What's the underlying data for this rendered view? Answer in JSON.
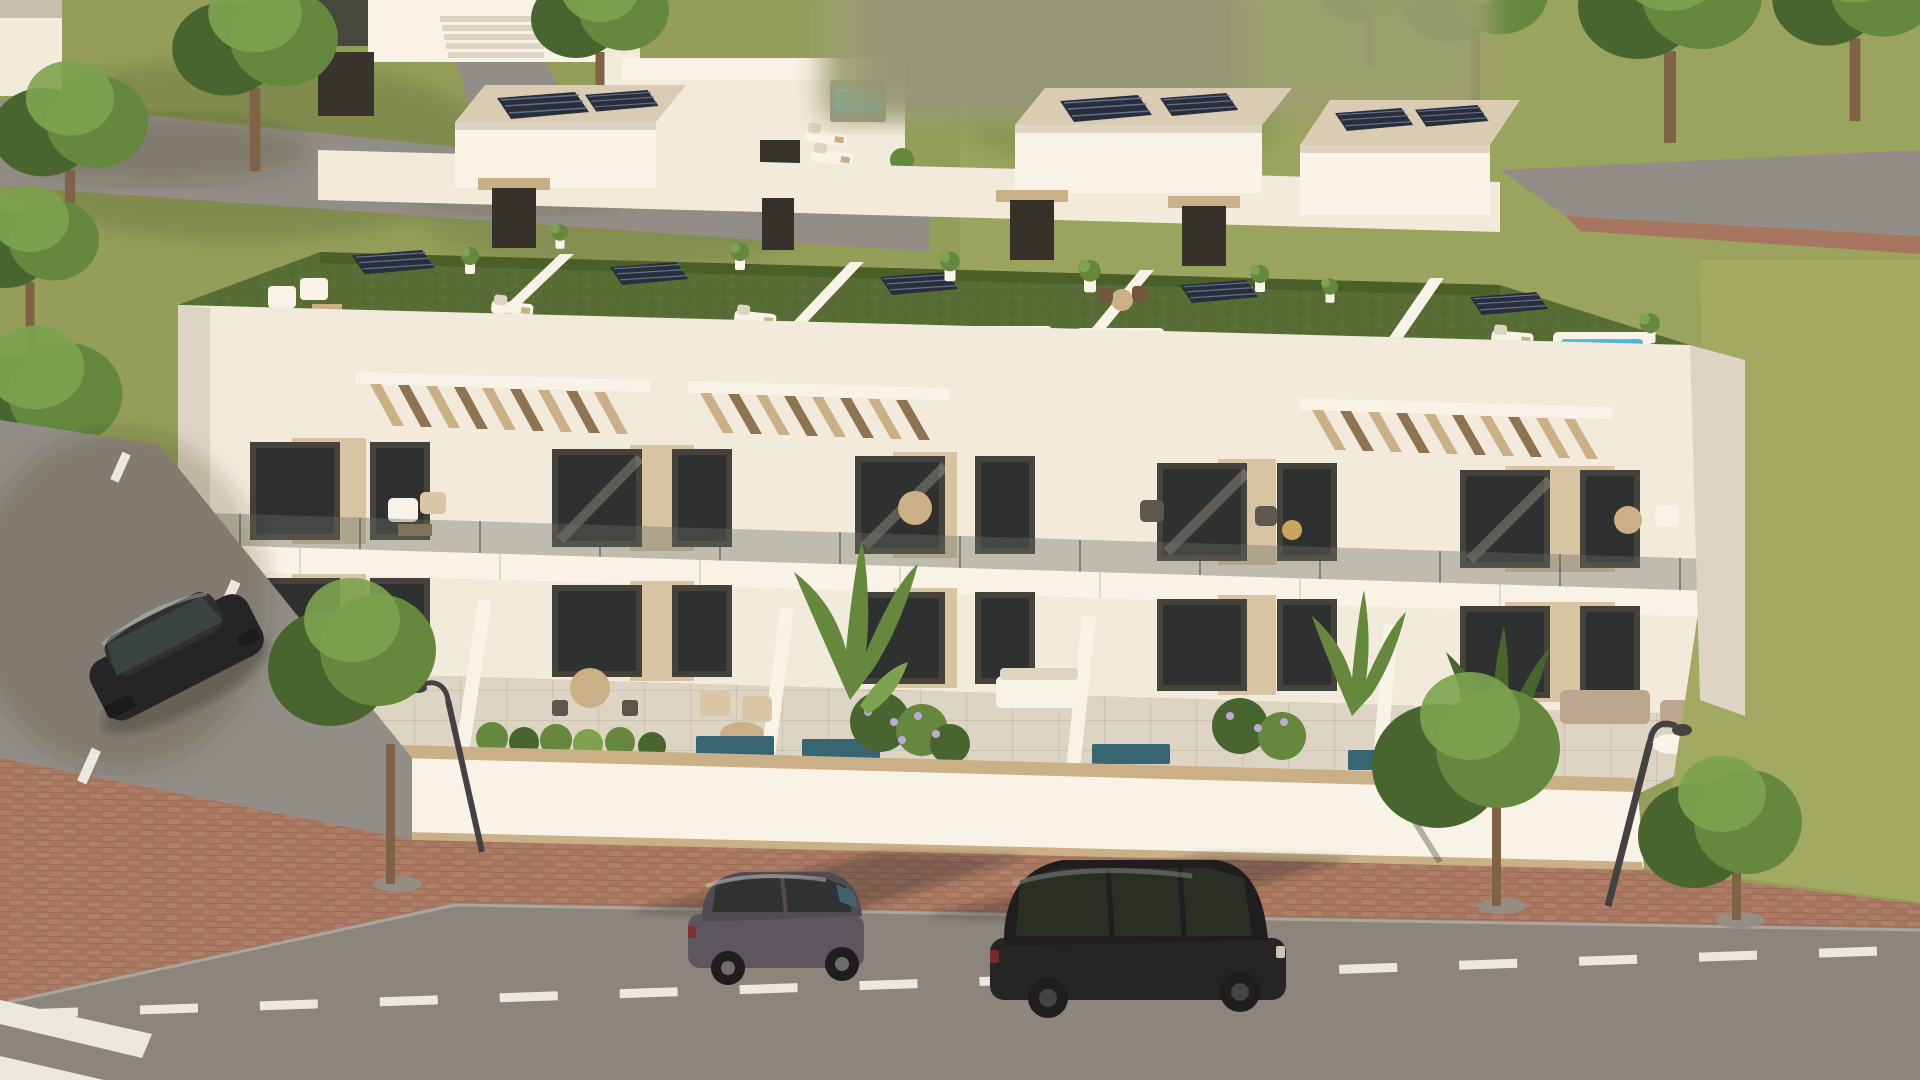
{
  "image": {
    "type": "3d-architectural-render",
    "view": "aerial three-quarter front view",
    "subject": "modern white residential townhouse block with landscaped roof terraces",
    "lighting": "warm late-afternoon sun from the right casting long shadows to the left",
    "blurred_area": "rectangular privacy blur over the background at the top centre"
  },
  "scene": {
    "building": {
      "units": 5,
      "visible_levels": [
        "ground-floor terraces",
        "first-floor balconies",
        "roof terraces",
        "penthouse stair boxes"
      ],
      "roof": {
        "surface": "artificial green turf",
        "jacuzzi_pools": 5,
        "water_color_hex": "#41b7d9",
        "flat_solar_panels": 5,
        "pergola_sections": 3,
        "penthouse_boxes": 3,
        "penthouse_roof": "beige gravel with rooftop solar panels",
        "stair_doors": "dark roller doors with beige canopies",
        "front_edge": "frameless glass balustrade",
        "furniture": [
          "white lounge chairs",
          "sun loungers",
          "wooden coffee tables",
          "bistro set",
          "potted plants"
        ]
      },
      "facade": {
        "walls": "white render",
        "accents": "light wood-look cladding panels",
        "glazing": "dark framed floor-to-ceiling sliding doors",
        "balcony_railing": "glass with slim posts",
        "balcony_furniture": [
          "round wooden table",
          "rattan armchairs",
          "sofas"
        ]
      },
      "ground_level": {
        "terraces": "large beige tiled patios",
        "plunge_pools": 5,
        "planting": [
          "clipped hedges",
          "flowering shrubs",
          "banana plants"
        ],
        "boundary_wall": "white wall with light wood coping and base trim",
        "furniture": [
          "white dining set",
          "round wooden dining table",
          "outdoor sofas",
          "coffee tables"
        ]
      }
    },
    "street": {
      "sidewalk": "red-brown brick pavers with street trees in circular pits",
      "road": "grey asphalt",
      "markings": [
        "dashed white centre line",
        "zebra crossing at bottom left",
        "dashes on the side street"
      ],
      "street_lamps": 2,
      "street_trees": 3
    },
    "vehicles": [
      {
        "name": "black-suv",
        "description": "black SUV driving on the main road, facing right"
      },
      {
        "name": "grey-hatchback",
        "description": "grey compact hatchback parked at the kerb"
      },
      {
        "name": "parked-black-car",
        "description": "dark car parked on the side street beside the building"
      }
    ],
    "background": {
      "lawns": "olive green grass with scattered trees",
      "paths": [
        "grey path crossing upper left",
        "vertical path at top",
        "road entering at upper right with paver edge"
      ],
      "neighbour_buildings": [
        "white villa with entrance steps at top left",
        "dark slatted fence",
        "small rear villa with grey hot tub and two loungers"
      ]
    }
  },
  "palette": {
    "grass": "#8f9b55",
    "grassLight": "#9da75f",
    "grassShade": "#66743e",
    "turf": "#4f682f",
    "turfShade": "#3f551f",
    "path": "#8d8a84",
    "road": "#85817a",
    "roadShade": "#6f6b64",
    "paver": "#a4715c",
    "paverLight": "#b3826b",
    "white": "#f2ecdf",
    "whiteLit": "#f9f4e9",
    "whiteShade": "#dcd4c4",
    "whiteDark": "#c6beac",
    "wood": "#c9ad85",
    "woodDark": "#8a6f4e",
    "clad": "#d6c3a2",
    "glassDark": "#24282a",
    "frame": "#3c3a35",
    "water": "#41b7d9",
    "waterLight": "#8adbec",
    "poolDark": "#2d5f6e",
    "panel": "#1d2534",
    "gravel": "#d9ccb3",
    "carGrey": "#55505a",
    "carBlack": "#1c1b1f",
    "tyre": "#141416",
    "marking": "#ece9e0",
    "lamp": "#39393b",
    "trunk": "#7a5c42",
    "leaf": "#5d8438",
    "leafDark": "#3f5f2a",
    "leafLight": "#77a14a",
    "blur": "#979d6e"
  }
}
